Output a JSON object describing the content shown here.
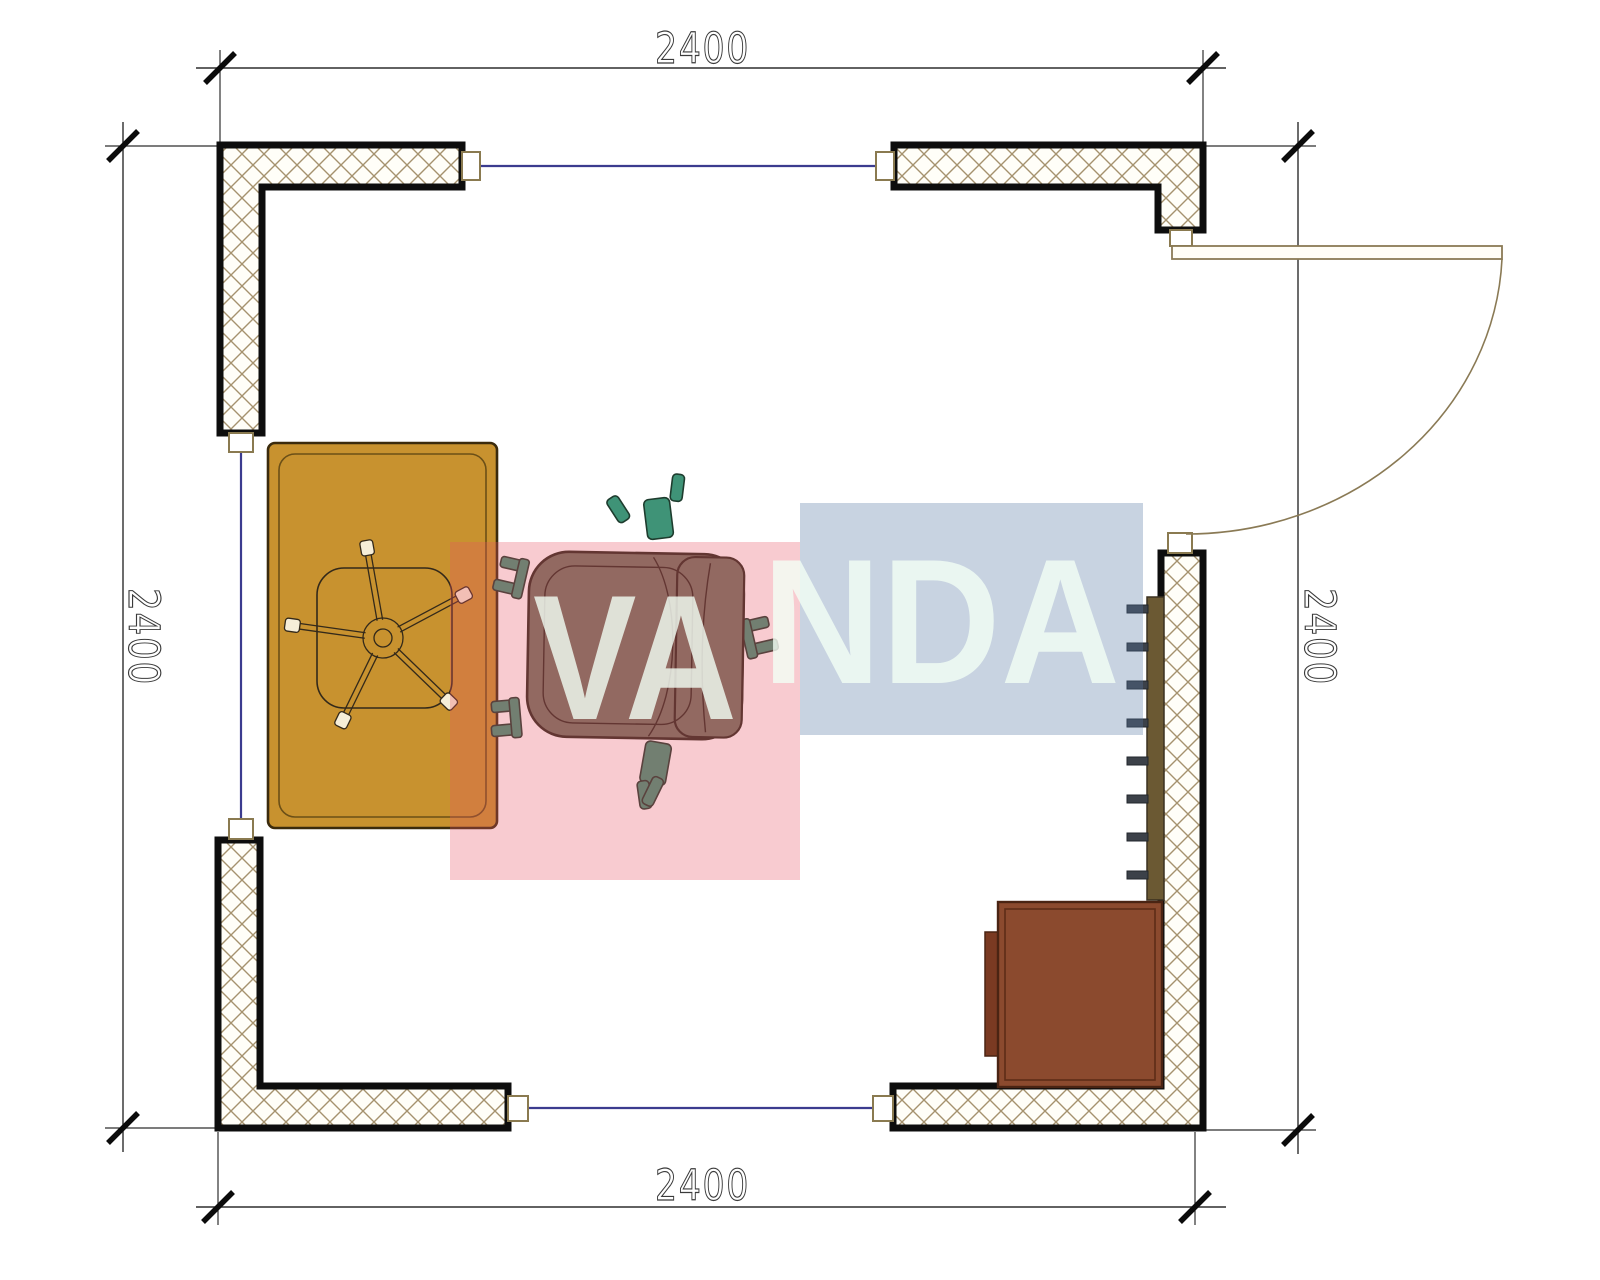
{
  "title": "Room floor plan 2400 x 2400 with desk, office chair, radiator and cabinet",
  "dimensions": {
    "top": "2400",
    "bottom": "2400",
    "left": "2400",
    "right": "2400"
  },
  "watermark": {
    "text_left": "VA",
    "text_right": "NDA",
    "full_text": "VANDA",
    "pink_fill": "rgba(233,84,100,0.30)",
    "blue_fill": "rgba(88,120,165,0.33)",
    "letter_fill": "rgba(242,255,245,0.80)"
  },
  "colors": {
    "desk": "#C8922F",
    "desk_edge": "#3b2b0d",
    "cabinet": "#8B4A2E",
    "cabinet_handle": "#7A3A22",
    "chair": "#6E7361",
    "chair_accent": "#3F9377",
    "radiator": "#6B5933",
    "radiator_fin": "#3C4149",
    "wall_hatch": "#A5926E",
    "wall_outline": "#0D0D0D",
    "window_line": "#3B3B8F",
    "door_line": "#8A7A55"
  }
}
